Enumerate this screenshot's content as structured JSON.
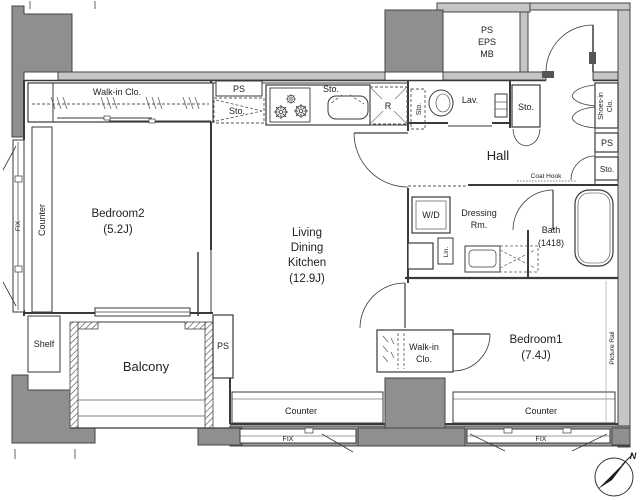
{
  "fp": {
    "rooms": {
      "bedroom2": {
        "name": "Bedroom2",
        "size": "(5.2J)"
      },
      "bedroom1": {
        "name": "Bedroom1",
        "size": "(7.4J)"
      },
      "ldk": {
        "l1": "Living",
        "l2": "Dining",
        "l3": "Kitchen",
        "size": "(12.9J)"
      },
      "hall": {
        "name": "Hall"
      },
      "balcony": {
        "name": "Balcony"
      },
      "bath": {
        "name": "Bath",
        "size": "(1418)"
      },
      "dressing": {
        "l1": "Dressing",
        "l2": "Rm."
      },
      "lav": {
        "name": "Lav."
      },
      "walkin_bedroom2": {
        "name": "Walk-in Clo."
      },
      "walkin_bedroom1": {
        "l1": "Walk-in",
        "l2": "Clo."
      },
      "shoes_in_closet": {
        "l1": "Shoes-in",
        "l2": "Clo."
      },
      "shaft": {
        "l1": "PS",
        "l2": "EPS",
        "l3": "MB"
      }
    },
    "labels": {
      "counter_bedroom2": "Counter",
      "counter_ldk": "Counter",
      "counter_bedroom1": "Counter",
      "fix_left": "FIX",
      "fix_ldk": "FIX",
      "fix_bedroom1": "FIX",
      "ps_kitchen": "PS",
      "ps_balcony": "PS",
      "ps_hall": "PS",
      "sto_kitchen": "Sto.",
      "sto_sink": "Sto.",
      "sto_lav": "Sto.",
      "sto_hall": "Sto.",
      "sto_hall_right": "Sto.",
      "sto_dressing": "Sto.",
      "fridge": "R",
      "washer": "W/D",
      "linen": "Lin.",
      "shelf": "Shelf",
      "coat_hook": "Coat Hook",
      "picture_rail": "Picture Rail",
      "north": "N"
    },
    "colors": {
      "wall": "#c6c6c6",
      "column": "#8f8f8f",
      "line": "#3a3a3a"
    }
  }
}
